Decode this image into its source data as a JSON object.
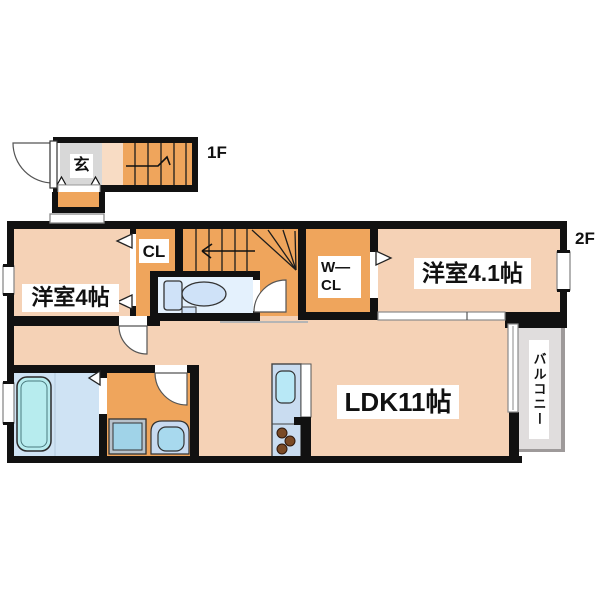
{
  "plan": {
    "title": "apartment-floor-plan",
    "floor_labels": {
      "f1": "1F",
      "f2": "2F"
    },
    "rooms": {
      "entrance": "玄",
      "closet": "CL",
      "walk_in_closet_lines": [
        "W—",
        "CL"
      ],
      "western_room_4": "洋室4帖",
      "western_room_4_1": "洋室4.1帖",
      "ldk": "LDK11帖",
      "balcony": "バルコニー"
    },
    "colors": {
      "wall": "#111111",
      "room_floor": "#f5d2b6",
      "accent_orange": "#efa55c",
      "stair_landing": "#f8dcc4",
      "entrance_gray": "#d8d8d8",
      "toilet_floor": "#e4f1fd",
      "bath_floor": "#cfe3f4",
      "bathtub": "#b7ecee",
      "fixture_blue": "#cfe2f8",
      "kitchen_counter": "#c9dcf0",
      "kitchen_sink": "#b8e8f6",
      "burner_brown": "#7a4a26",
      "balcony_gray": "#e0dddd",
      "balcony_rail": "#9e9a9a",
      "window_frame": "#8a8a8a"
    }
  }
}
